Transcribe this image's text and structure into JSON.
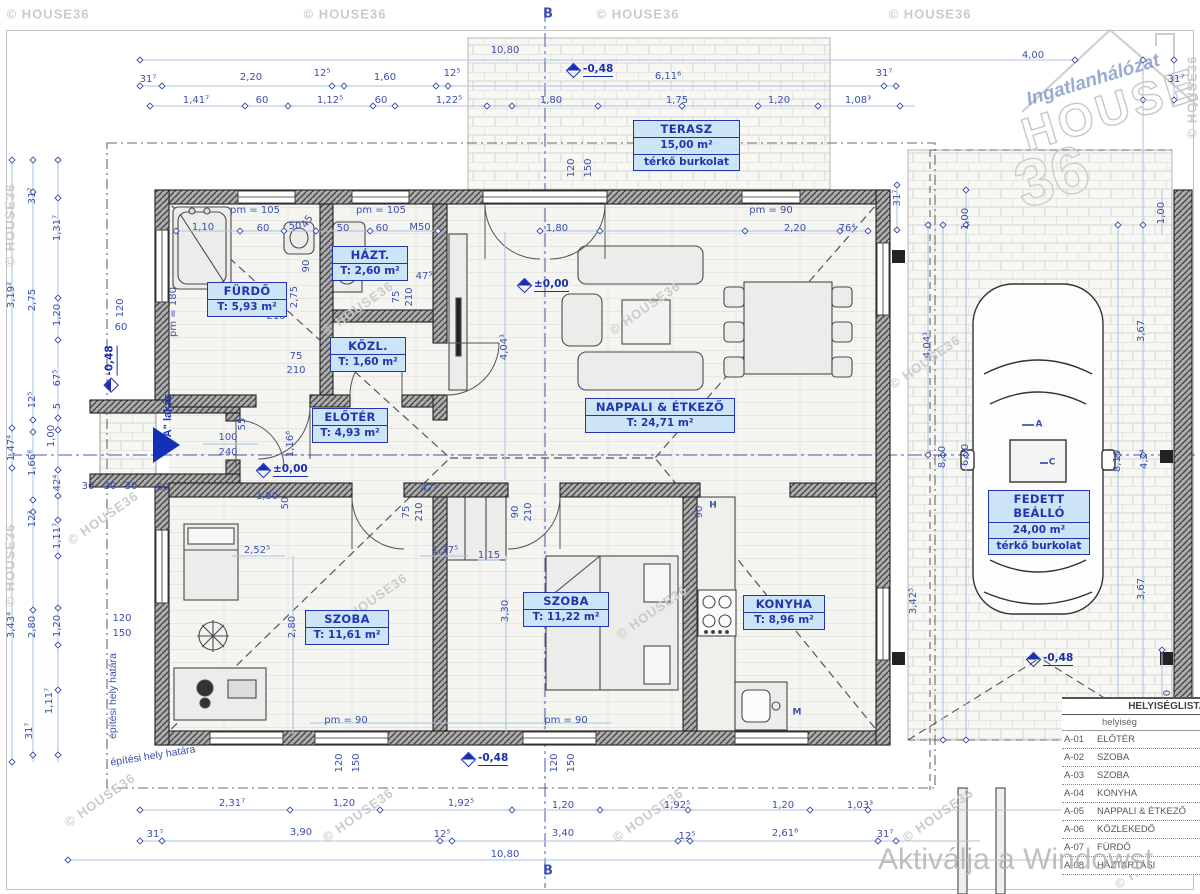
{
  "watermark": "© HOUSE36",
  "activate": "Aktiválja a Windowst",
  "logo": {
    "tagline": "Ingatlanhálózat",
    "brand": "HOUSE",
    "number": "36"
  },
  "entrance": {
    "label": "\"A\" lakás"
  },
  "site_labels": {
    "boundary_1": "építési hely határa",
    "boundary_2": "építési hely határa"
  },
  "colors": {
    "dim_text": "#3b4fae",
    "dim_line": "#a9c6e2",
    "label_blue": "#2136ae",
    "label_fill": "#cde4f6",
    "level_blue": "#1a2fae"
  },
  "rooms": [
    {
      "id": "terasz",
      "x": 633,
      "y": 120,
      "w": 107,
      "lines": [
        "TERASZ",
        "15,00 m²",
        "térkő burkolat"
      ]
    },
    {
      "id": "furdo",
      "x": 207,
      "y": 282,
      "w": 80,
      "lines": [
        "FÜRDŐ",
        "T: 5,93 m²"
      ]
    },
    {
      "id": "haztartasi",
      "x": 332,
      "y": 246,
      "w": 76,
      "lines": [
        "HÁZT.",
        "T: 2,60 m²"
      ]
    },
    {
      "id": "kozlekedo",
      "x": 330,
      "y": 337,
      "w": 76,
      "lines": [
        "KÖZL.",
        "T: 1,60 m²"
      ]
    },
    {
      "id": "eloter",
      "x": 312,
      "y": 408,
      "w": 76,
      "lines": [
        "ELŐTÉR",
        "T: 4,93 m²"
      ]
    },
    {
      "id": "nappali",
      "x": 585,
      "y": 398,
      "w": 150,
      "lines": [
        "NAPPALI & ÉTKEZŐ",
        "T: 24,71 m²"
      ]
    },
    {
      "id": "szoba-1",
      "x": 305,
      "y": 610,
      "w": 84,
      "lines": [
        "SZOBA",
        "T: 11,61 m²"
      ]
    },
    {
      "id": "szoba-2",
      "x": 523,
      "y": 592,
      "w": 86,
      "lines": [
        "SZOBA",
        "T: 11,22 m²"
      ]
    },
    {
      "id": "konyha",
      "x": 743,
      "y": 595,
      "w": 82,
      "lines": [
        "KONYHA",
        "T: 8,96 m²"
      ]
    },
    {
      "id": "fedett-beallo",
      "x": 988,
      "y": 490,
      "w": 102,
      "lines": [
        "FEDETT BEÁLLÓ",
        "24,00 m²",
        "térkő burkolat"
      ]
    }
  ],
  "room_table": {
    "title": "HELYISÉGLISTA",
    "col": "helyiség",
    "rows": [
      [
        "A-01",
        "ELŐTÉR"
      ],
      [
        "A-02",
        "SZOBA"
      ],
      [
        "A-03",
        "SZOBA"
      ],
      [
        "A-04",
        "KONYHA"
      ],
      [
        "A-05",
        "NAPPALI & ÉTKEZŐ"
      ],
      [
        "A-06",
        "KÖZLEKEDŐ"
      ],
      [
        "A-07",
        "FÜRDŐ"
      ],
      [
        "A-08",
        "HÁZTARTÁSI"
      ]
    ]
  },
  "levels": [
    [
      "±0,00",
      519,
      285,
      0
    ],
    [
      "±0,00",
      258,
      470,
      0
    ],
    [
      "-0,48",
      568,
      70,
      0
    ],
    [
      "-0,48",
      88,
      368,
      -90
    ],
    [
      "-0,48",
      463,
      759,
      0
    ],
    [
      "-0,48",
      1028,
      659,
      0
    ]
  ],
  "dims": [
    [
      "10,80",
      505,
      51
    ],
    [
      "31⁷",
      148,
      80
    ],
    [
      "2,20",
      251,
      78
    ],
    [
      "12⁵",
      322,
      74
    ],
    [
      "1,60",
      385,
      78
    ],
    [
      "12⁵",
      452,
      74
    ],
    [
      "6,11⁶",
      668,
      77
    ],
    [
      "31⁷",
      884,
      74
    ],
    [
      "4,00",
      1033,
      56
    ],
    [
      "1,41⁷",
      196,
      101
    ],
    [
      "60",
      262,
      101
    ],
    [
      "1,12⁵",
      330,
      101
    ],
    [
      "60",
      381,
      101
    ],
    [
      "1,22⁵",
      449,
      101
    ],
    [
      "1,80",
      551,
      101
    ],
    [
      "1,75",
      677,
      101
    ],
    [
      "1,20",
      779,
      101
    ],
    [
      "1,08³",
      858,
      101
    ],
    [
      "31⁷",
      1176,
      80
    ],
    [
      "B",
      548,
      14,
      0,
      13
    ],
    [
      "B",
      548,
      871,
      0,
      13
    ],
    [
      "pm = 105",
      255,
      211
    ],
    [
      "pm = 105",
      381,
      211
    ],
    [
      "pm = 90",
      771,
      211
    ],
    [
      "1,10",
      203,
      228
    ],
    [
      "60",
      263,
      229
    ],
    [
      "50",
      295,
      227
    ],
    [
      "45",
      308,
      222,
      -55
    ],
    [
      "50",
      343,
      229
    ],
    [
      "60",
      382,
      229
    ],
    [
      "M50",
      420,
      228
    ],
    [
      "1,80",
      557,
      229
    ],
    [
      "2,20",
      795,
      229
    ],
    [
      "76⁴",
      847,
      229
    ],
    [
      "120",
      572,
      168,
      -90
    ],
    [
      "150",
      589,
      168,
      -90
    ],
    [
      "pm = 180",
      174,
      312,
      -90
    ],
    [
      "120",
      121,
      308,
      -90
    ],
    [
      "60",
      121,
      328
    ],
    [
      "2,75",
      295,
      297,
      -90
    ],
    [
      "90",
      307,
      266,
      -90
    ],
    [
      "210",
      276,
      317
    ],
    [
      "75",
      397,
      297,
      -90
    ],
    [
      "210",
      410,
      297,
      -90
    ],
    [
      "47⁵",
      424,
      277
    ],
    [
      "75",
      296,
      357
    ],
    [
      "210",
      296,
      371
    ],
    [
      "75",
      407,
      512,
      -90
    ],
    [
      "210",
      420,
      512,
      -90
    ],
    [
      "47⁵",
      429,
      489
    ],
    [
      "100",
      228,
      438
    ],
    [
      "240",
      228,
      453
    ],
    [
      "55",
      243,
      424,
      -90
    ],
    [
      "1,16⁶",
      291,
      444,
      -90
    ],
    [
      "30",
      88,
      487
    ],
    [
      "30",
      110,
      487
    ],
    [
      "30",
      131,
      487
    ],
    [
      "60",
      163,
      488
    ],
    [
      "1,80",
      267,
      497
    ],
    [
      "50",
      286,
      503,
      -90
    ],
    [
      "4,04¹",
      505,
      347,
      -90
    ],
    [
      "2,52⁵",
      257,
      551
    ],
    [
      "1,37⁵",
      445,
      551
    ],
    [
      "1,15",
      489,
      556
    ],
    [
      "90",
      516,
      512,
      -90
    ],
    [
      "210",
      529,
      512,
      -90
    ],
    [
      "90",
      700,
      512,
      -90
    ],
    [
      "H",
      713,
      506,
      0,
      9
    ],
    [
      "3,30",
      506,
      611,
      -90
    ],
    [
      "2,80",
      293,
      627,
      -90
    ],
    [
      "120",
      122,
      619
    ],
    [
      "150",
      122,
      634
    ],
    [
      "M",
      797,
      713,
      0,
      9
    ],
    [
      "pm = 90",
      346,
      721
    ],
    [
      "pm = 90",
      566,
      721
    ],
    [
      "120",
      340,
      763,
      -90
    ],
    [
      "150",
      357,
      763,
      -90
    ],
    [
      "120",
      555,
      763,
      -90
    ],
    [
      "150",
      572,
      763,
      -90
    ],
    [
      "2,31⁷",
      232,
      804
    ],
    [
      "1,20",
      344,
      804
    ],
    [
      "1,92⁵",
      461,
      804
    ],
    [
      "1,20",
      563,
      806
    ],
    [
      "1,92⁵",
      677,
      806
    ],
    [
      "1,20",
      783,
      806
    ],
    [
      "1,03³",
      860,
      806
    ],
    [
      "31⁷",
      155,
      835
    ],
    [
      "3,90",
      301,
      833
    ],
    [
      "12⁵",
      442,
      835
    ],
    [
      "3,40",
      563,
      834
    ],
    [
      "12⁵",
      687,
      837
    ],
    [
      "2,61⁶",
      785,
      834
    ],
    [
      "31⁷",
      885,
      835
    ],
    [
      "10,80",
      505,
      855
    ],
    [
      "31⁷",
      33,
      196,
      -90
    ],
    [
      "1,31⁷",
      58,
      228,
      -90
    ],
    [
      "3,19²",
      12,
      295,
      -90
    ],
    [
      "2,75",
      33,
      300,
      -90
    ],
    [
      "1,20",
      58,
      315,
      -90
    ],
    [
      "67⁵",
      58,
      378,
      -90
    ],
    [
      "12⁵",
      33,
      400,
      -90
    ],
    [
      "5",
      58,
      406,
      -90
    ],
    [
      "1,00",
      52,
      436,
      -90
    ],
    [
      "1,47⁴",
      12,
      448,
      -90
    ],
    [
      "1,66⁸",
      33,
      463,
      -90
    ],
    [
      "42⁴",
      58,
      483,
      -90
    ],
    [
      "12³",
      33,
      519,
      -90
    ],
    [
      "1,11⁷",
      58,
      536,
      -90
    ],
    [
      "3,43⁴",
      12,
      625,
      -90
    ],
    [
      "2,80",
      33,
      627,
      -90
    ],
    [
      "1,20",
      58,
      626,
      -90
    ],
    [
      "1,11⁷",
      50,
      701,
      -90
    ],
    [
      "31⁷",
      30,
      731,
      -90
    ],
    [
      "31⁷",
      898,
      198,
      -90
    ],
    [
      "1,00",
      966,
      219,
      -90
    ],
    [
      "4,04¹",
      928,
      345,
      -90
    ],
    [
      "8,10",
      943,
      457,
      -90
    ],
    [
      "6,00",
      966,
      455,
      -90
    ],
    [
      "3,42⁵",
      914,
      601,
      -90
    ],
    [
      "1,00",
      1162,
      213,
      -90
    ],
    [
      "3,67",
      1142,
      331,
      -90
    ],
    [
      "8,10",
      1118,
      461,
      -90
    ],
    [
      "4,2⁴",
      1145,
      459,
      -90
    ],
    [
      "3,67",
      1142,
      589,
      -90
    ],
    [
      "1,10",
      1168,
      701,
      -90
    ],
    [
      "A",
      1039,
      425,
      0,
      9
    ],
    [
      "C",
      1052,
      463,
      0,
      9
    ]
  ],
  "watermarks": [
    [
      48,
      14,
      0
    ],
    [
      345,
      14,
      0
    ],
    [
      638,
      14,
      0
    ],
    [
      930,
      14,
      0
    ],
    [
      10,
      225,
      -90
    ],
    [
      10,
      565,
      -90
    ],
    [
      103,
      518,
      -35
    ],
    [
      100,
      800,
      -35
    ],
    [
      358,
      308,
      -35
    ],
    [
      645,
      308,
      -35
    ],
    [
      925,
      362,
      -35
    ],
    [
      372,
      600,
      -35
    ],
    [
      652,
      612,
      -35
    ],
    [
      358,
      815,
      -35
    ],
    [
      648,
      815,
      -35
    ],
    [
      938,
      815,
      -35
    ],
    [
      1192,
      97,
      -90
    ],
    [
      1150,
      862,
      -35
    ]
  ]
}
